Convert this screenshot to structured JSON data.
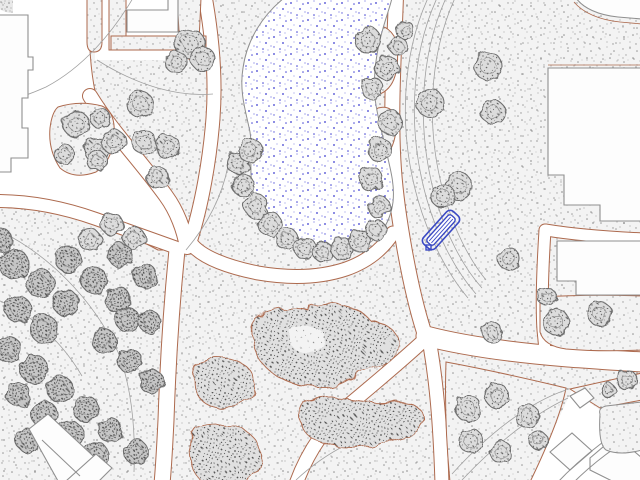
{
  "canvas": {
    "width": 640,
    "height": 480
  },
  "palette": {
    "background": "#ffffff",
    "grass_base": "#f3f3f3",
    "grass_dot": "#9a9a9a",
    "grass_dot_dark": "#7c7c7c",
    "path_edge_sienna": "#ad6a4e",
    "building_outline": "#8f8f8f",
    "building_fill": "#fdfdfd",
    "tree_outline": "#6e6e6e",
    "tree_fill": "#dcdcdc",
    "tree_fill_dark": "#c6c6c6",
    "shrub_base": "#e0e0e0",
    "shrub_dot": "#555555",
    "contour_line": "#a0a0a0",
    "pond_outline": "#8f8f8f",
    "pond_dot_blue": "#3c3cd0",
    "bench_blue": "#3a49c4"
  },
  "map": {
    "pond": {
      "d": "M284,-2 C262,16 247,40 243,68 C239,92 246,112 250,132 C253,150 249,166 252,186 C256,209 268,229 289,243 C309,255 335,257 357,249 C377,242 390,225 393,202 C395,184 390,168 386,150 C382,132 377,116 375,98 C373,76 376,54 382,32 C386,17 390,7 392,-2 Z"
    },
    "white_zones": [
      {
        "name": "plaza-west",
        "d": "M30,-2 L90,-2 C88,40 90,72 97,100 C110,136 138,162 166,197 C178,212 185,232 182,250 L158,250 C128,234 94,217 55,211 L-2,207 L-2,-2 Z",
        "stroke": "#ad6a4e"
      },
      {
        "name": "walkway-north",
        "d": "M95,-2 H212 V60 H95 Z",
        "stroke": "none"
      },
      {
        "name": "road-zone-southeast",
        "d": "M640,404 L600,410 L572,390 L528,484 L644,484 Z",
        "stroke": "none"
      }
    ],
    "corridors": [
      {
        "name": "path-pond-west",
        "d": "M205,-4 C212,35 216,78 213,118 C210,158 202,205 190,242",
        "w": 13
      },
      {
        "name": "path-pond-south",
        "d": "M190,242 C200,257 228,267 258,273 C293,279 322,277 346,269 C366,262 382,250 393,233",
        "w": 13
      },
      {
        "name": "path-pond-east",
        "d": "M396,-4 C394,55 390,115 394,170 C397,212 409,285 424,332",
        "w": 14
      },
      {
        "name": "path-plaza-diagonal",
        "d": "M90,96 C112,132 140,160 166,196 C177,211 184,230 187,247",
        "w": 14
      },
      {
        "name": "path-south-vertical",
        "d": "M177,250 C172,300 168,360 166,420 C165,440 164,462 162,484",
        "w": 15
      },
      {
        "name": "path-west-exit",
        "d": "M-4,201 C30,201 62,207 96,219 C130,231 158,241 180,249",
        "w": 12
      },
      {
        "name": "path-east-exit",
        "d": "M426,336 C468,347 518,353 568,357 C595,359 620,361 644,362",
        "w": 19
      },
      {
        "name": "path-southwest-branch",
        "d": "M422,342 C398,364 374,384 350,404 C329,422 308,450 296,484",
        "w": 13
      },
      {
        "name": "path-south-branch",
        "d": "M430,345 C436,380 440,420 442,484",
        "w": 13
      },
      {
        "name": "path-east-vertical",
        "d": "M545,230 C543,262 541,300 543,330 L545,350",
        "w": 11
      },
      {
        "name": "path-between-buildings",
        "d": "M546,230 C570,234 602,237 644,239",
        "w": 11
      }
    ],
    "grass_islands": [
      {
        "name": "grass-strip-a",
        "d": "M87,-2 H102 V42 Q102,52 94,52 Q87,52 87,42 Z",
        "stroke": "#ad6a4e"
      },
      {
        "name": "grass-strip-b",
        "d": "M109,-2 H126 V50 H109 Z",
        "stroke": "#ad6a4e"
      },
      {
        "name": "grass-strip-c",
        "d": "M111,36 H206 V50 H111 Z",
        "stroke": "#ad6a4e"
      },
      {
        "name": "grass-strip-d",
        "d": "M177,-2 H201 L198,64 Q186,60 180,48 Z",
        "stroke": "#ad6a4e"
      },
      {
        "name": "grass-island-plaza",
        "d": "M58,107 Q80,100 102,106 Q116,112 114,136 Q112,162 96,172 Q74,180 60,168 Q48,150 50,128 Q52,112 58,107 Z",
        "stroke": "#ad6a4e"
      },
      {
        "name": "grass-lobe-pond-east-1",
        "d": "M362,28 Q384,20 394,36 Q400,52 396,72 Q392,92 374,96 Q358,98 354,80 Q352,60 354,46 Q356,34 362,28 Z",
        "stroke": "#ad6a4e"
      },
      {
        "name": "grass-lobe-pond-east-2",
        "d": "M378,108 Q394,104 396,122 Q397,140 388,154 Q378,164 368,156 Q362,146 366,130 Q370,114 378,108 Z",
        "stroke": "#ad6a4e"
      },
      {
        "name": "grass-east-mid",
        "d": "M540,297 Q590,294 642,296 L642,350 Q600,352 566,349 Q544,346 540,332 Z",
        "stroke": "#ad6a4e"
      },
      {
        "name": "grass-east-sliver",
        "d": "M570,389 L642,373 L642,400 L600,408 Z",
        "stroke": "#ad6a4e"
      },
      {
        "name": "grass-triangle-south",
        "d": "M446,362 Q500,372 566,388 Q560,420 530,482 L450,482 Q444,420 446,362 Z",
        "stroke": "#ad6a4e"
      },
      {
        "name": "grass-corner-dark",
        "d": "M-2,-2 H13 V13 Q5,13 -2,8 Z",
        "stroke": "none"
      }
    ],
    "contours": [
      {
        "d": "M133,-2 C112,34 82,68 46,87 C26,96 8,101 -2,103",
        "c": "#a0a0a0"
      },
      {
        "d": "M97,60 C138,86 178,97 213,94",
        "c": "#a0a0a0"
      },
      {
        "d": "M428,-2 C402,55 398,130 418,200 C428,235 446,272 468,298",
        "c": "#a0a0a0"
      },
      {
        "d": "M437,-2 C411,55 407,130 427,200 C437,235 455,270 476,294",
        "c": "#a0a0a0"
      },
      {
        "d": "M446,-2 C420,55 416,130 436,200 C446,233 462,266 482,288",
        "c": "#a0a0a0"
      },
      {
        "d": "M455,-2 C429,55 425,130 445,198 C454,228 468,258 486,280",
        "c": "#a0a0a0"
      },
      {
        "d": "M452,474 C490,432 530,402 566,390",
        "c": "#a0a0a0"
      },
      {
        "d": "M462,480 C498,442 534,414 568,398",
        "c": "#a0a0a0"
      },
      {
        "d": "M-2,230 C48,254 92,298 118,352 C130,382 136,424 134,472",
        "c": "#a0a0a0"
      },
      {
        "d": "M-2,300 C34,316 62,342 82,376",
        "c": "#a0a0a0"
      },
      {
        "d": "M186,250 C208,224 222,196 228,166",
        "c": "#a0a0a0"
      },
      {
        "d": "M296,480 C326,452 364,432 408,424",
        "c": "#a0a0a0"
      },
      {
        "d": "M548,65 L642,65",
        "c": "#ad6a4e"
      },
      {
        "d": "M574,2 C583,13 600,20 620,22 L642,24",
        "c": "#ad6a4e"
      }
    ],
    "shrubs": [
      {
        "name": "shrub-mass-center",
        "d": "M252,338 Q248,318 272,312 Q292,306 308,310 Q322,300 344,306 Q362,310 370,320 Q394,324 398,340 Q400,358 380,366 Q364,370 352,378 Q336,390 314,387 Q292,386 274,374 Q256,362 252,338 Z",
        "fill": "shrub"
      },
      {
        "name": "shrub-mass-hole",
        "d": "M290,330 Q304,322 318,328 Q330,336 322,348 Q310,356 296,350 Q286,342 290,330 Z",
        "fill": "grass"
      },
      {
        "name": "shrub-mass-round",
        "d": "M200,362 Q226,352 246,366 Q260,380 252,396 Q240,410 218,408 Q198,404 194,386 Q192,370 200,362 Z",
        "fill": "shrub"
      },
      {
        "name": "shrub-mass-long",
        "d": "M302,402 Q330,394 352,400 Q372,404 390,402 Q412,398 422,412 Q428,426 412,434 Q392,440 368,446 Q344,450 324,444 Q306,438 300,424 Q296,410 302,402 Z",
        "fill": "shrub"
      },
      {
        "name": "shrub-mass-bottom",
        "d": "M196,428 Q222,420 244,430 Q262,440 260,462 Q256,480 240,484 L204,484 Q190,470 190,448 Q190,434 196,428 Z",
        "fill": "shrub"
      }
    ],
    "trees": [
      [
        190,
        44,
        15,
        "n"
      ],
      [
        203,
        59,
        12,
        "n"
      ],
      [
        176,
        62,
        11,
        "n"
      ],
      [
        76,
        124,
        13,
        "n"
      ],
      [
        96,
        150,
        12,
        "n"
      ],
      [
        64,
        154,
        10,
        "n"
      ],
      [
        100,
        118,
        10,
        "n"
      ],
      [
        140,
        104,
        13,
        "n"
      ],
      [
        114,
        142,
        12,
        "n"
      ],
      [
        144,
        142,
        12,
        "n"
      ],
      [
        168,
        147,
        12,
        "n"
      ],
      [
        97,
        161,
        10,
        "n"
      ],
      [
        157,
        177,
        11,
        "n"
      ],
      [
        238,
        163,
        11,
        "n"
      ],
      [
        250,
        150,
        12,
        "n"
      ],
      [
        243,
        185,
        11,
        "n"
      ],
      [
        256,
        206,
        12,
        "n"
      ],
      [
        270,
        224,
        12,
        "n"
      ],
      [
        287,
        239,
        11,
        "n"
      ],
      [
        305,
        248,
        11,
        "n"
      ],
      [
        323,
        252,
        10,
        "n"
      ],
      [
        342,
        249,
        11,
        "n"
      ],
      [
        360,
        241,
        11,
        "n"
      ],
      [
        376,
        230,
        10,
        "n"
      ],
      [
        368,
        40,
        13,
        "n"
      ],
      [
        387,
        68,
        12,
        "n"
      ],
      [
        372,
        88,
        11,
        "n"
      ],
      [
        390,
        122,
        12,
        "n"
      ],
      [
        380,
        150,
        12,
        "n"
      ],
      [
        371,
        179,
        12,
        "n"
      ],
      [
        379,
        207,
        11,
        "n"
      ],
      [
        398,
        46,
        9,
        "n"
      ],
      [
        405,
        30,
        9,
        "n"
      ],
      [
        488,
        66,
        14,
        "n"
      ],
      [
        430,
        103,
        14,
        "n"
      ],
      [
        493,
        112,
        12,
        "n"
      ],
      [
        458,
        186,
        14,
        "n"
      ],
      [
        443,
        196,
        12,
        "n"
      ],
      [
        556,
        322,
        13,
        "n"
      ],
      [
        600,
        314,
        12,
        "n"
      ],
      [
        627,
        380,
        10,
        "n"
      ],
      [
        547,
        297,
        9,
        "n"
      ],
      [
        509,
        259,
        11,
        "n"
      ],
      [
        492,
        332,
        10,
        "n"
      ],
      [
        468,
        408,
        13,
        "n"
      ],
      [
        497,
        396,
        12,
        "n"
      ],
      [
        527,
        416,
        12,
        "n"
      ],
      [
        471,
        441,
        12,
        "n"
      ],
      [
        501,
        452,
        11,
        "n"
      ],
      [
        538,
        440,
        9,
        "n"
      ],
      [
        112,
        224,
        11,
        "n"
      ],
      [
        90,
        240,
        11,
        "n"
      ],
      [
        134,
        238,
        11,
        "n"
      ],
      [
        608,
        390,
        7,
        "n"
      ],
      [
        14,
        264,
        15,
        "d"
      ],
      [
        40,
        283,
        14,
        "d"
      ],
      [
        66,
        303,
        13,
        "d"
      ],
      [
        18,
        309,
        13,
        "d"
      ],
      [
        44,
        329,
        14,
        "d"
      ],
      [
        8,
        349,
        13,
        "d"
      ],
      [
        34,
        369,
        14,
        "d"
      ],
      [
        60,
        389,
        13,
        "d"
      ],
      [
        86,
        409,
        13,
        "d"
      ],
      [
        18,
        394,
        12,
        "d"
      ],
      [
        44,
        414,
        13,
        "d"
      ],
      [
        70,
        434,
        13,
        "d"
      ],
      [
        96,
        454,
        12,
        "d"
      ],
      [
        28,
        440,
        12,
        "d"
      ],
      [
        118,
        300,
        13,
        "d"
      ],
      [
        94,
        280,
        13,
        "d"
      ],
      [
        68,
        259,
        13,
        "d"
      ],
      [
        120,
        255,
        12,
        "d"
      ],
      [
        145,
        276,
        12,
        "d"
      ],
      [
        128,
        320,
        12,
        "d"
      ],
      [
        104,
        341,
        12,
        "d"
      ],
      [
        130,
        361,
        12,
        "d"
      ],
      [
        152,
        382,
        12,
        "d"
      ],
      [
        110,
        430,
        12,
        "d"
      ],
      [
        136,
        452,
        12,
        "d"
      ],
      [
        150,
        322,
        11,
        "d"
      ],
      [
        0,
        240,
        12,
        "d"
      ]
    ],
    "buildings": [
      {
        "name": "building-west",
        "d": "M-2,15 H28 V57 H33 V70 H28 V98 H22 V128 H28 V158 H11 V172 H-2 Z"
      },
      {
        "name": "building-north",
        "d": "M127,32 V10 H168 V-2 H178 V32 Z"
      },
      {
        "name": "building-northeast-corner",
        "d": "M576,-2 C583,8 598,15 618,17 L642,19 V-2 Z"
      },
      {
        "name": "building-east-large",
        "d": "M548,68 H642 V221 H600 V205 H564 V175 H548 Z"
      },
      {
        "name": "building-east-lower",
        "d": "M557,241 H642 V295 H576 V281 H557 Z"
      },
      {
        "name": "building-southwest-a",
        "d": "M29,429 L48,414 L105,467 L90,481 L58,481 Z"
      },
      {
        "name": "building-southwest-b",
        "d": "M66,481 L96,454 L112,468 L99,481 Z"
      },
      {
        "name": "building-southeast-a",
        "d": "M550,452 L572,433 L592,451 L570,470 Z"
      },
      {
        "name": "building-southeast-b",
        "d": "M590,458 L616,436 L642,458 V481 H612 L590,470 Z"
      },
      {
        "name": "building-southeast-c",
        "d": "M570,396 L585,388 L594,398 L580,408 Z"
      }
    ],
    "building_lines": [
      {
        "d": "M42,440 L80,476",
        "c": "#8f8f8f"
      },
      {
        "d": "M556,484 C586,452 616,432 642,416",
        "c": "#8f8f8f"
      },
      {
        "d": "M572,484 C600,456 624,442 642,430",
        "c": "#8f8f8f"
      }
    ],
    "grass_patch_road": {
      "name": "grass-patch-southeast",
      "d": "M600,414 Q598,408 606,406 L642,402 V450 Q620,456 606,450 Q598,444 600,414 Z"
    },
    "bench": {
      "cx": 441,
      "cy": 230,
      "rotation": -48,
      "length": 44,
      "width": 16,
      "inner_length": 36,
      "inner_width": 9,
      "grip": {
        "x": 426,
        "y": 245,
        "size": 5
      }
    }
  }
}
